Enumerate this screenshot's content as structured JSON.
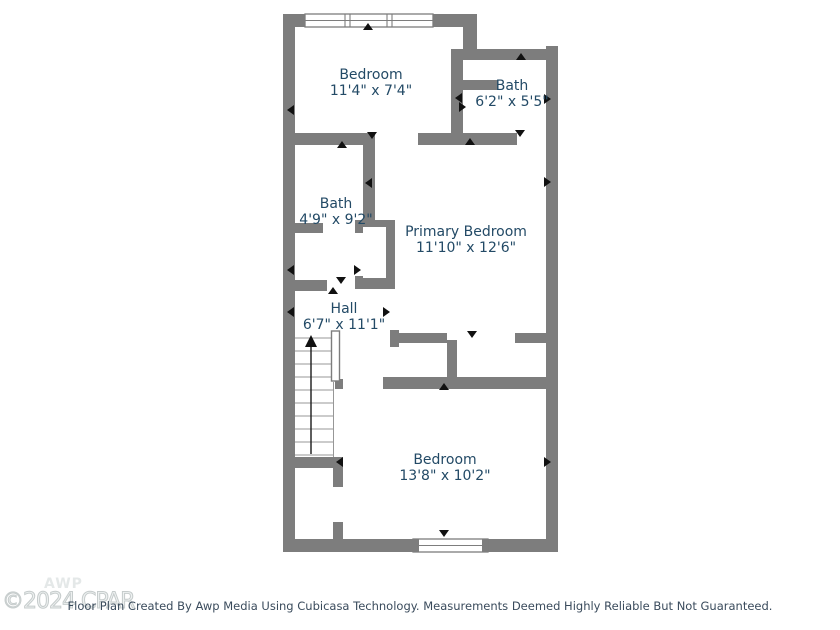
{
  "watermark": {
    "logo": "AWP",
    "copyright": "©2024 CPAR"
  },
  "footer": {
    "disclaimer": "Floor Plan Created By Awp Media Using Cubicasa Technology. Measurements Deemed Highly Reliable But Not Guaranteed."
  },
  "floor_plan": {
    "rooms": [
      {
        "name": "Bedroom",
        "dimensions": "11'4\" x 7'4\""
      },
      {
        "name": "Bath",
        "dimensions": "6'2\" x 5'5\""
      },
      {
        "name": "Bath",
        "dimensions": "4'9\" x 9'2\""
      },
      {
        "name": "Primary Bedroom",
        "dimensions": "11'10\" x 12'6\""
      },
      {
        "name": "Hall",
        "dimensions": "6'7\" x 11'1\""
      },
      {
        "name": "Bedroom",
        "dimensions": "13'8\" x 10'2\""
      }
    ],
    "stairs": {
      "direction": "up"
    },
    "window_count": 2,
    "colors": {
      "wall": "#7d7d7d",
      "label": "#234a66",
      "marker": "#111111"
    }
  }
}
